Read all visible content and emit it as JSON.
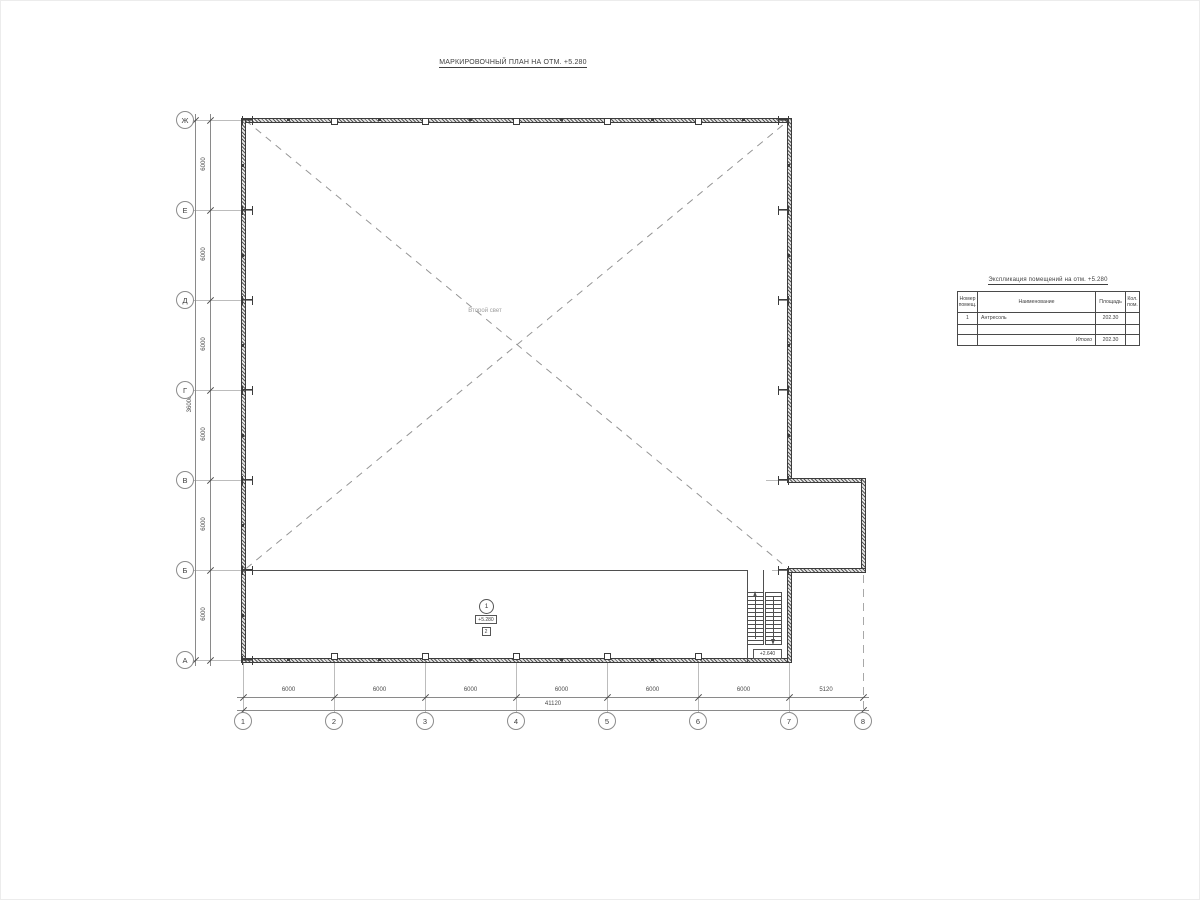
{
  "drawing": {
    "title": "МАРКИРОВОЧНЫЙ ПЛАН НА ОТМ. +5.280"
  },
  "axes": {
    "row_labels": [
      "Ж",
      "Е",
      "Д",
      "Г",
      "В",
      "Б",
      "А"
    ],
    "col_labels": [
      "1",
      "2",
      "3",
      "4",
      "5",
      "6",
      "7",
      "8"
    ],
    "row_dims": [
      "6000",
      "6000",
      "6000",
      "6000",
      "6000",
      "6000"
    ],
    "row_total": "36000",
    "col_dims": [
      "6000",
      "6000",
      "6000",
      "6000",
      "6000",
      "6000",
      "5120"
    ],
    "col_total": "41120"
  },
  "plan": {
    "void_label": "Второй свет",
    "room_number": "1",
    "room_elevation": "+5.280",
    "floor_type_mark": "2",
    "stair_level_mark": "+2.640"
  },
  "spec_table": {
    "title": "Экспликация помещений на отм. +5.280",
    "headers": [
      "Номер помещ.",
      "Наименование",
      "Площадь",
      "Кол. пом."
    ],
    "rows": [
      [
        "1",
        "Антресоль",
        "202.30",
        ""
      ],
      [
        "",
        "",
        "",
        ""
      ],
      [
        "",
        "Итого",
        "202.30",
        ""
      ]
    ]
  },
  "colors": {
    "wall_line": "#3c3c3c",
    "aux_line": "#bcbcbc",
    "dim_line": "#8a8a8a",
    "text": "#4a4a4a"
  }
}
